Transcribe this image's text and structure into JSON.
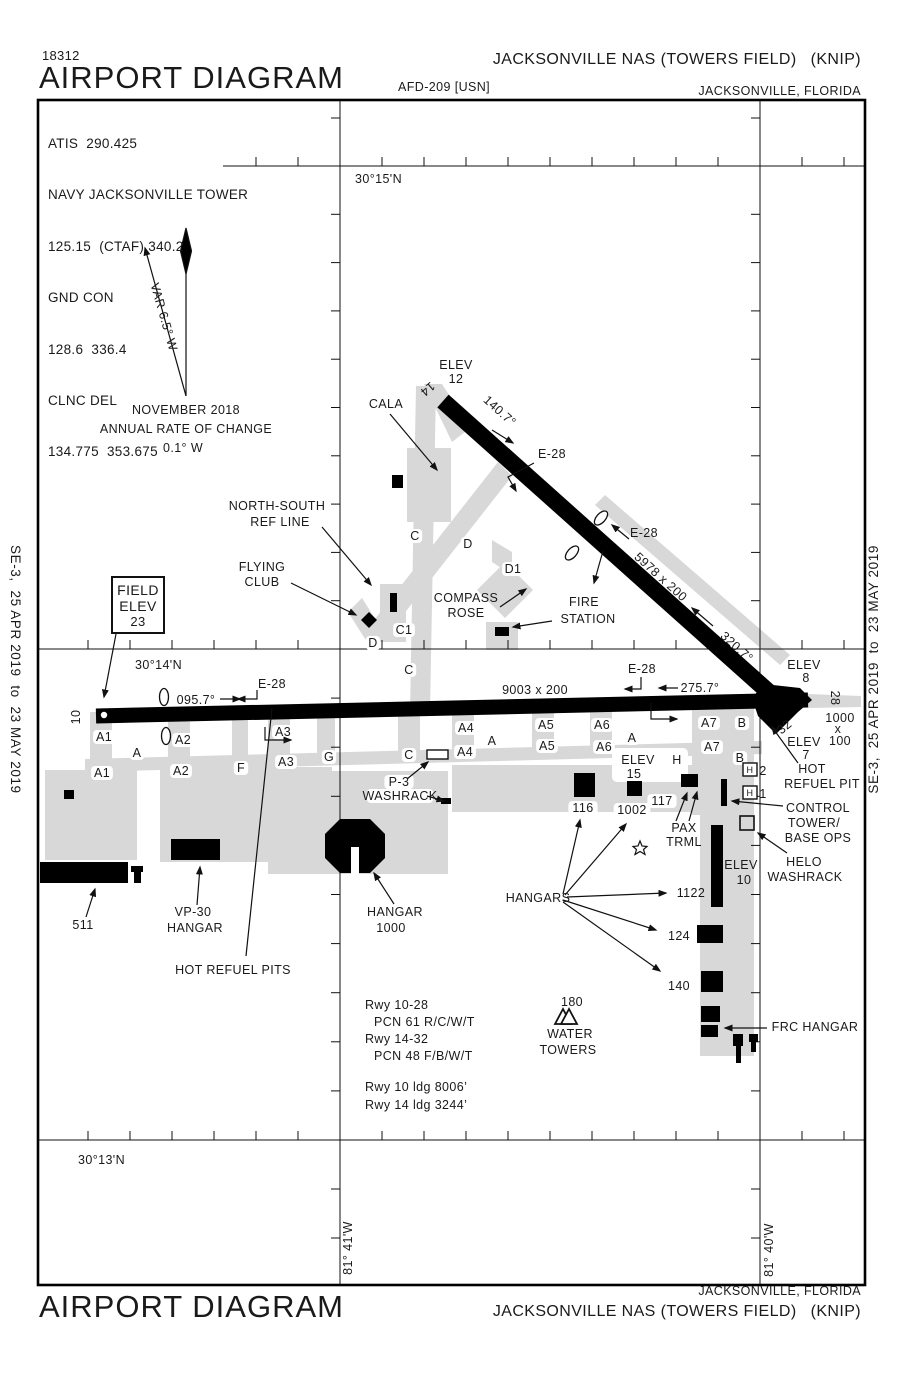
{
  "header": {
    "chart_number": "18312",
    "title": "AIRPORT DIAGRAM",
    "afd_ref": "AFD-209 [USN]",
    "airport_name": "JACKSONVILLE NAS (TOWERS FIELD)",
    "airport_code": "(KNIP)",
    "city": "JACKSONVILLE, FLORIDA"
  },
  "footer": {
    "title": "AIRPORT DIAGRAM",
    "airport_name": "JACKSONVILLE NAS (TOWERS FIELD)",
    "airport_code": "(KNIP)",
    "city": "JACKSONVILLE, FLORIDA"
  },
  "sidebars": {
    "effective_dates": "SE-3,  25 APR 2019  to  23 MAY 2019"
  },
  "comms": {
    "lines": [
      "ATIS  290.425",
      "NAVY JACKSONVILLE TOWER",
      "125.15  (CTAF) 340.2",
      "GND CON",
      "128.6  336.4",
      "CLNC DEL",
      "134.775  353.675"
    ]
  },
  "magnetic": {
    "variation": "VAR 6.5° W",
    "date": "NOVEMBER 2018",
    "rate_label": "ANNUAL RATE OF CHANGE",
    "rate_value": "0.1° W"
  },
  "map": {
    "labels": [
      {
        "n": "lat-30-15",
        "t": "30°15'N",
        "x": 355,
        "y": 183,
        "a": "start"
      },
      {
        "n": "lat-30-14",
        "t": "30°14'N",
        "x": 135,
        "y": 669,
        "a": "start"
      },
      {
        "n": "lat-30-13",
        "t": "30°13'N",
        "x": 78,
        "y": 1164,
        "a": "start"
      },
      {
        "n": "lon-81-41",
        "t": "81° 41'W",
        "x": 352,
        "y": 1248,
        "r": -90
      },
      {
        "n": "lon-81-40",
        "t": "81° 40'W",
        "x": 773,
        "y": 1250,
        "r": -90
      },
      {
        "n": "mag-date",
        "t": "NOVEMBER 2018",
        "x": 186,
        "y": 414
      },
      {
        "n": "mag-rate1",
        "t": "ANNUAL RATE OF CHANGE",
        "x": 186,
        "y": 433
      },
      {
        "n": "mag-rate2",
        "t": "0.1° W",
        "x": 183,
        "y": 452
      },
      {
        "n": "mag-var",
        "t": "VAR 6.5° W",
        "x": 160,
        "y": 318,
        "r": 74
      },
      {
        "n": "cala",
        "t": "CALA",
        "x": 386,
        "y": 408
      },
      {
        "n": "ns-ref-1",
        "t": "NORTH-SOUTH",
        "x": 277,
        "y": 510
      },
      {
        "n": "ns-ref-2",
        "t": "REF LINE",
        "x": 280,
        "y": 526
      },
      {
        "n": "flying-club-1",
        "t": "FLYING",
        "x": 262,
        "y": 571
      },
      {
        "n": "flying-club-2",
        "t": "CLUB",
        "x": 262,
        "y": 586
      },
      {
        "n": "field-elev-1",
        "t": "FIELD",
        "x": 138,
        "y": 595,
        "s": 14
      },
      {
        "n": "field-elev-2",
        "t": "ELEV",
        "x": 138,
        "y": 611,
        "s": 14
      },
      {
        "n": "field-elev-3",
        "t": "23",
        "x": 138,
        "y": 626,
        "s": 13
      },
      {
        "n": "elev12-1",
        "t": "ELEV",
        "x": 456,
        "y": 369
      },
      {
        "n": "elev12-2",
        "t": "12",
        "x": 456,
        "y": 383
      },
      {
        "n": "rwy-num-14",
        "t": "14",
        "x": 425,
        "y": 386,
        "r": 140
      },
      {
        "n": "hdg-140",
        "t": "140.7°",
        "x": 497,
        "y": 414,
        "r": 42
      },
      {
        "n": "e28-rwy14-hi",
        "t": "E-28",
        "x": 552,
        "y": 458
      },
      {
        "n": "e28-rwy14-lo",
        "t": "E-28",
        "x": 644,
        "y": 537
      },
      {
        "n": "rwy1432-dim",
        "t": "5978 x 200",
        "x": 658,
        "y": 580,
        "r": 42
      },
      {
        "n": "hdg-320",
        "t": "320.7°",
        "x": 734,
        "y": 650,
        "r": 42
      },
      {
        "n": "twy-c-n",
        "t": "C",
        "x": 415,
        "y": 540,
        "bg": 1
      },
      {
        "n": "twy-d-n",
        "t": "D",
        "x": 468,
        "y": 548,
        "bg": 1
      },
      {
        "n": "twy-d1",
        "t": "D1",
        "x": 513,
        "y": 573,
        "bg": 1
      },
      {
        "n": "compass-1",
        "t": "COMPASS",
        "x": 466,
        "y": 602
      },
      {
        "n": "compass-2",
        "t": "ROSE",
        "x": 466,
        "y": 617
      },
      {
        "n": "fire-1",
        "t": "FIRE",
        "x": 584,
        "y": 606
      },
      {
        "n": "fire-2",
        "t": "STATION",
        "x": 588,
        "y": 623
      },
      {
        "n": "twy-c1",
        "t": "C1",
        "x": 404,
        "y": 634,
        "bg": 1
      },
      {
        "n": "twy-d-s",
        "t": "D",
        "x": 373,
        "y": 647,
        "bg": 1
      },
      {
        "n": "twy-c-mid",
        "t": "C",
        "x": 409,
        "y": 674,
        "bg": 1
      },
      {
        "n": "e28-west",
        "t": "E-28",
        "x": 272,
        "y": 688
      },
      {
        "n": "hdg-095",
        "t": "095.7°",
        "x": 196,
        "y": 704
      },
      {
        "n": "rwy1028-dim",
        "t": "9003 x 200",
        "x": 535,
        "y": 694
      },
      {
        "n": "e28-mid",
        "t": "E-28",
        "x": 642,
        "y": 673
      },
      {
        "n": "hdg-275",
        "t": "275.7°",
        "x": 700,
        "y": 692
      },
      {
        "n": "elev8-1",
        "t": "ELEV",
        "x": 804,
        "y": 669
      },
      {
        "n": "elev8-2",
        "t": "8",
        "x": 806,
        "y": 682
      },
      {
        "n": "rwy-num-28",
        "t": "28",
        "x": 831,
        "y": 698,
        "r": 90
      },
      {
        "n": "overrun-1",
        "t": "1000",
        "x": 840,
        "y": 722
      },
      {
        "n": "overrun-2",
        "t": "x",
        "x": 838,
        "y": 733
      },
      {
        "n": "overrun-3",
        "t": "100",
        "x": 840,
        "y": 745
      },
      {
        "n": "rwy-num-32",
        "t": "32",
        "x": 787,
        "y": 730,
        "r": -40
      },
      {
        "n": "elev7-1",
        "t": "ELEV",
        "x": 804,
        "y": 746
      },
      {
        "n": "elev7-2",
        "t": "7",
        "x": 806,
        "y": 759
      },
      {
        "n": "rwy-num-10",
        "t": "10",
        "x": 80,
        "y": 717,
        "r": -90
      },
      {
        "n": "twy-a1-u",
        "t": "A1",
        "x": 104,
        "y": 741,
        "bg": 1
      },
      {
        "n": "twy-a2-u",
        "t": "A2",
        "x": 183,
        "y": 744,
        "bg": 1
      },
      {
        "n": "twy-a3-u",
        "t": "A3",
        "x": 283,
        "y": 736,
        "bg": 1
      },
      {
        "n": "twy-a4-u",
        "t": "A4",
        "x": 466,
        "y": 732,
        "bg": 1
      },
      {
        "n": "twy-a5-u",
        "t": "A5",
        "x": 546,
        "y": 729,
        "bg": 1
      },
      {
        "n": "twy-a6-u",
        "t": "A6",
        "x": 602,
        "y": 729,
        "bg": 1
      },
      {
        "n": "twy-a7-u",
        "t": "A7",
        "x": 709,
        "y": 727,
        "bg": 1
      },
      {
        "n": "twy-b-u",
        "t": "B",
        "x": 742,
        "y": 727,
        "bg": 1
      },
      {
        "n": "twy-a-w",
        "t": "A",
        "x": 137,
        "y": 757,
        "bg": 1
      },
      {
        "n": "twy-a1-l",
        "t": "A1",
        "x": 102,
        "y": 777,
        "bg": 1
      },
      {
        "n": "twy-a2-l",
        "t": "A2",
        "x": 181,
        "y": 775,
        "bg": 1
      },
      {
        "n": "twy-f",
        "t": "F",
        "x": 241,
        "y": 772,
        "bg": 1
      },
      {
        "n": "twy-a3-l",
        "t": "A3",
        "x": 286,
        "y": 766,
        "bg": 1
      },
      {
        "n": "twy-g",
        "t": "G",
        "x": 329,
        "y": 761,
        "bg": 1
      },
      {
        "n": "twy-c-s",
        "t": "C",
        "x": 409,
        "y": 759,
        "bg": 1
      },
      {
        "n": "twy-a-m1",
        "t": "A",
        "x": 492,
        "y": 745,
        "bg": 1
      },
      {
        "n": "twy-a4-l",
        "t": "A4",
        "x": 465,
        "y": 756,
        "bg": 1
      },
      {
        "n": "twy-a5-l",
        "t": "A5",
        "x": 547,
        "y": 750,
        "bg": 1
      },
      {
        "n": "twy-a6-l",
        "t": "A6",
        "x": 604,
        "y": 751,
        "bg": 1
      },
      {
        "n": "twy-a-m2",
        "t": "A",
        "x": 632,
        "y": 742,
        "bg": 1
      },
      {
        "n": "twy-a7-l",
        "t": "A7",
        "x": 712,
        "y": 751,
        "bg": 1
      },
      {
        "n": "twy-b-l",
        "t": "B",
        "x": 740,
        "y": 762,
        "bg": 1
      },
      {
        "n": "twy-h",
        "t": "H",
        "x": 677,
        "y": 764,
        "bg": 1
      },
      {
        "n": "elev15-1",
        "t": "ELEV",
        "x": 638,
        "y": 764
      },
      {
        "n": "elev15-2",
        "t": "15",
        "x": 634,
        "y": 778
      },
      {
        "n": "p3-1",
        "t": "P-3",
        "x": 399,
        "y": 786,
        "bg": 1
      },
      {
        "n": "p3-2",
        "t": "WASHRACK",
        "x": 400,
        "y": 800,
        "bg": 1
      },
      {
        "n": "bldg-116",
        "t": "116",
        "x": 583,
        "y": 812,
        "bg": 1
      },
      {
        "n": "bldg-1002",
        "t": "1002",
        "x": 632,
        "y": 814,
        "bg": 1
      },
      {
        "n": "bldg-117",
        "t": "117",
        "x": 662,
        "y": 805,
        "bg": 1
      },
      {
        "n": "pax-1",
        "t": "PAX",
        "x": 684,
        "y": 832
      },
      {
        "n": "pax-2",
        "t": "TRML",
        "x": 684,
        "y": 846
      },
      {
        "n": "hpad-2",
        "t": "2",
        "x": 763,
        "y": 775
      },
      {
        "n": "hpad-1",
        "t": "1",
        "x": 763,
        "y": 798
      },
      {
        "n": "hpad-h2",
        "t": "H",
        "x": 750,
        "y": 773,
        "s": 9
      },
      {
        "n": "hpad-h1",
        "t": "H",
        "x": 750,
        "y": 796,
        "s": 9
      },
      {
        "n": "hot-pit-1",
        "t": "HOT",
        "x": 812,
        "y": 773
      },
      {
        "n": "hot-pit-2",
        "t": "REFUEL PIT",
        "x": 822,
        "y": 788
      },
      {
        "n": "ctl-1",
        "t": "CONTROL",
        "x": 818,
        "y": 812
      },
      {
        "n": "ctl-2",
        "t": "TOWER/",
        "x": 814,
        "y": 827
      },
      {
        "n": "ctl-3",
        "t": "BASE OPS",
        "x": 818,
        "y": 842
      },
      {
        "n": "helo-1",
        "t": "HELO",
        "x": 804,
        "y": 866
      },
      {
        "n": "helo-2",
        "t": "WASHRACK",
        "x": 805,
        "y": 881
      },
      {
        "n": "elev10-1",
        "t": "ELEV",
        "x": 741,
        "y": 869
      },
      {
        "n": "elev10-2",
        "t": "10",
        "x": 744,
        "y": 884
      },
      {
        "n": "bldg-1122",
        "t": "1122",
        "x": 691,
        "y": 897
      },
      {
        "n": "bldg-124",
        "t": "124",
        "x": 679,
        "y": 940
      },
      {
        "n": "bldg-140",
        "t": "140",
        "x": 679,
        "y": 990
      },
      {
        "n": "frc-hangar",
        "t": "FRC HANGAR",
        "x": 815,
        "y": 1031
      },
      {
        "n": "hangars",
        "t": "HANGARS",
        "x": 538,
        "y": 902
      },
      {
        "n": "bldg-511",
        "t": "511",
        "x": 83,
        "y": 929
      },
      {
        "n": "vp30-1",
        "t": "VP-30",
        "x": 193,
        "y": 916
      },
      {
        "n": "vp30-2",
        "t": "HANGAR",
        "x": 195,
        "y": 932
      },
      {
        "n": "hangar1000-1",
        "t": "HANGAR",
        "x": 395,
        "y": 916
      },
      {
        "n": "hangar1000-2",
        "t": "1000",
        "x": 391,
        "y": 932
      },
      {
        "n": "hot-pits",
        "t": "HOT REFUEL PITS",
        "x": 233,
        "y": 974
      },
      {
        "n": "wt-180",
        "t": "180",
        "x": 572,
        "y": 1006
      },
      {
        "n": "wt-1",
        "t": "WATER",
        "x": 570,
        "y": 1038
      },
      {
        "n": "wt-2",
        "t": "TOWERS",
        "x": 568,
        "y": 1054
      },
      {
        "n": "rwy-data-1",
        "t": "Rwy 10-28",
        "x": 365,
        "y": 1009,
        "a": "start"
      },
      {
        "n": "rwy-data-2",
        "t": "PCN 61 R/C/W/T",
        "x": 374,
        "y": 1026,
        "a": "start"
      },
      {
        "n": "rwy-data-3",
        "t": "Rwy 14-32",
        "x": 365,
        "y": 1043,
        "a": "start"
      },
      {
        "n": "rwy-data-4",
        "t": "PCN 48 F/B/W/T",
        "x": 374,
        "y": 1060,
        "a": "start"
      },
      {
        "n": "rwy-data-5",
        "t": "Rwy 10 ldg 8006’",
        "x": 365,
        "y": 1091,
        "a": "start"
      },
      {
        "n": "rwy-data-6",
        "t": "Rwy 14 ldg 3244’",
        "x": 365,
        "y": 1109,
        "a": "start"
      }
    ]
  }
}
